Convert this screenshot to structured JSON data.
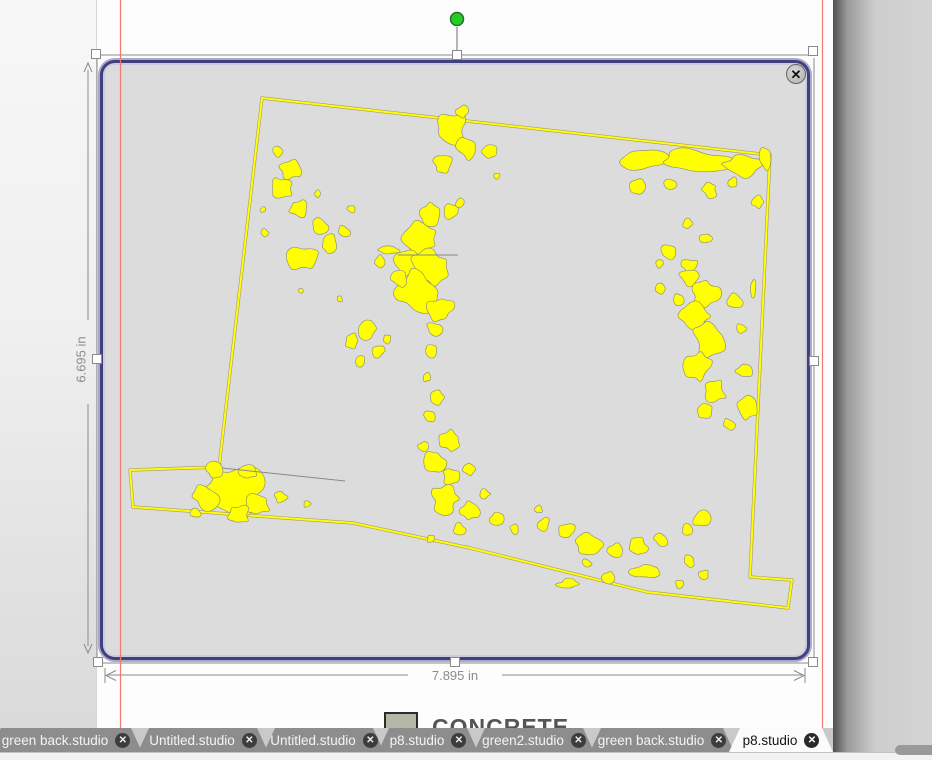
{
  "selection": {
    "width_label": "7.895 in",
    "height_label": "6.695 in"
  },
  "material": {
    "label": "CONCRETE",
    "swatch_color": "#b6b6a6"
  },
  "tabs": [
    {
      "label": "green back.studio",
      "active": false
    },
    {
      "label": "Untitled.studio",
      "active": false
    },
    {
      "label": "Untitled.studio",
      "active": false
    },
    {
      "label": "p8.studio",
      "active": false
    },
    {
      "label": "green2.studio",
      "active": false
    },
    {
      "label": "green back.studio",
      "active": false
    },
    {
      "label": "p8.studio",
      "active": true
    }
  ],
  "icons": {
    "close": "✕",
    "tab_close": "✕"
  },
  "colors": {
    "trace_fill": "#ffff00",
    "trace_edge": "#93937a",
    "outline_shadow": "#a89a74",
    "selection_border": "#40407c",
    "margin_line": "#f07a72",
    "canvas_fill": "#dcdcdc",
    "rotate_handle_green": "#22cf22",
    "guide_gray": "#8a8a8a"
  },
  "trace": {
    "outline": [
      [
        262,
        98
      ],
      [
        770,
        155
      ],
      [
        750,
        577
      ],
      [
        792,
        580
      ],
      [
        788,
        608
      ],
      [
        647,
        592
      ],
      [
        470,
        548
      ],
      [
        353,
        523
      ],
      [
        133,
        507
      ],
      [
        130,
        470
      ],
      [
        219,
        467
      ]
    ],
    "inner_lines": [
      [
        [
          222,
          468
        ],
        [
          345,
          481
        ]
      ],
      [
        [
          398,
          255
        ],
        [
          458,
          255
        ]
      ]
    ],
    "blobs": [
      [
        452,
        128,
        16
      ],
      [
        468,
        148,
        11
      ],
      [
        443,
        164,
        9
      ],
      [
        490,
        152,
        7
      ],
      [
        497,
        176,
        4
      ],
      [
        462,
        112,
        6
      ],
      [
        640,
        160,
        14,
        1.7,
        0.75
      ],
      [
        695,
        162,
        18,
        1.9,
        0.65
      ],
      [
        742,
        166,
        14,
        1.5,
        0.8
      ],
      [
        638,
        188,
        8
      ],
      [
        670,
        184,
        6
      ],
      [
        710,
        190,
        7
      ],
      [
        733,
        182,
        5
      ],
      [
        758,
        202,
        6
      ],
      [
        764,
        158,
        8,
        0.8,
        1.4
      ],
      [
        688,
        224,
        5
      ],
      [
        706,
        238,
        6
      ],
      [
        668,
        252,
        7
      ],
      [
        690,
        266,
        8
      ],
      [
        290,
        170,
        10
      ],
      [
        281,
        189,
        12
      ],
      [
        299,
        209,
        9
      ],
      [
        321,
        227,
        8
      ],
      [
        344,
        231,
        6
      ],
      [
        329,
        245,
        10
      ],
      [
        303,
        258,
        12,
        1.35,
        1
      ],
      [
        265,
        233,
        4
      ],
      [
        263,
        210,
        3
      ],
      [
        318,
        194,
        4
      ],
      [
        351,
        209,
        4
      ],
      [
        277,
        152,
        5
      ],
      [
        430,
        214,
        11
      ],
      [
        451,
        211,
        8
      ],
      [
        420,
        239,
        15
      ],
      [
        408,
        261,
        13
      ],
      [
        430,
        267,
        17
      ],
      [
        418,
        291,
        19,
        1.15,
        1
      ],
      [
        398,
        277,
        10
      ],
      [
        441,
        309,
        12
      ],
      [
        389,
        250,
        8,
        1.6,
        0.5
      ],
      [
        379,
        261,
        6
      ],
      [
        459,
        204,
        5
      ],
      [
        434,
        329,
        8
      ],
      [
        367,
        329,
        9
      ],
      [
        352,
        341,
        7
      ],
      [
        377,
        351,
        8
      ],
      [
        360,
        361,
        5
      ],
      [
        387,
        339,
        5
      ],
      [
        431,
        351,
        6
      ],
      [
        427,
        377,
        5
      ],
      [
        437,
        397,
        7
      ],
      [
        429,
        417,
        6
      ],
      [
        340,
        299,
        3
      ],
      [
        301,
        291,
        3
      ],
      [
        689,
        277,
        9
      ],
      [
        705,
        294,
        13
      ],
      [
        694,
        317,
        15
      ],
      [
        711,
        341,
        17,
        1,
        1.2
      ],
      [
        699,
        367,
        13
      ],
      [
        715,
        391,
        11
      ],
      [
        705,
        411,
        9
      ],
      [
        735,
        301,
        7
      ],
      [
        741,
        329,
        6
      ],
      [
        679,
        299,
        6
      ],
      [
        661,
        289,
        5
      ],
      [
        744,
        371,
        8
      ],
      [
        729,
        424,
        6
      ],
      [
        747,
        407,
        9,
        1,
        1.3
      ],
      [
        659,
        264,
        4
      ],
      [
        753,
        290,
        6,
        0.55,
        1.6
      ],
      [
        451,
        441,
        11
      ],
      [
        435,
        461,
        10
      ],
      [
        451,
        477,
        8
      ],
      [
        469,
        469,
        6
      ],
      [
        445,
        499,
        13
      ],
      [
        469,
        511,
        9
      ],
      [
        497,
        519,
        7
      ],
      [
        515,
        529,
        5
      ],
      [
        423,
        447,
        5
      ],
      [
        485,
        494,
        5
      ],
      [
        459,
        529,
        6
      ],
      [
        431,
        539,
        4
      ],
      [
        544,
        524,
        6
      ],
      [
        567,
        531,
        8
      ],
      [
        589,
        544,
        10,
        1.3,
        1
      ],
      [
        614,
        551,
        8
      ],
      [
        639,
        547,
        9
      ],
      [
        661,
        539,
        7
      ],
      [
        687,
        531,
        6
      ],
      [
        701,
        519,
        8
      ],
      [
        647,
        571,
        10,
        1.5,
        0.6
      ],
      [
        609,
        577,
        7
      ],
      [
        587,
        564,
        5
      ],
      [
        569,
        584,
        8,
        1.4,
        0.6
      ],
      [
        689,
        561,
        6
      ],
      [
        704,
        574,
        5
      ],
      [
        679,
        584,
        4
      ],
      [
        539,
        509,
        4
      ],
      [
        232,
        489,
        24,
        1.25,
        1
      ],
      [
        205,
        497,
        12
      ],
      [
        257,
        504,
        12
      ],
      [
        239,
        515,
        10
      ],
      [
        214,
        470,
        8
      ],
      [
        249,
        471,
        9
      ],
      [
        281,
        497,
        6
      ],
      [
        307,
        504,
        4
      ],
      [
        196,
        514,
        5
      ]
    ]
  },
  "layout_labels": {
    "rotate_handle": "rotate",
    "selection_handle": "resize"
  }
}
